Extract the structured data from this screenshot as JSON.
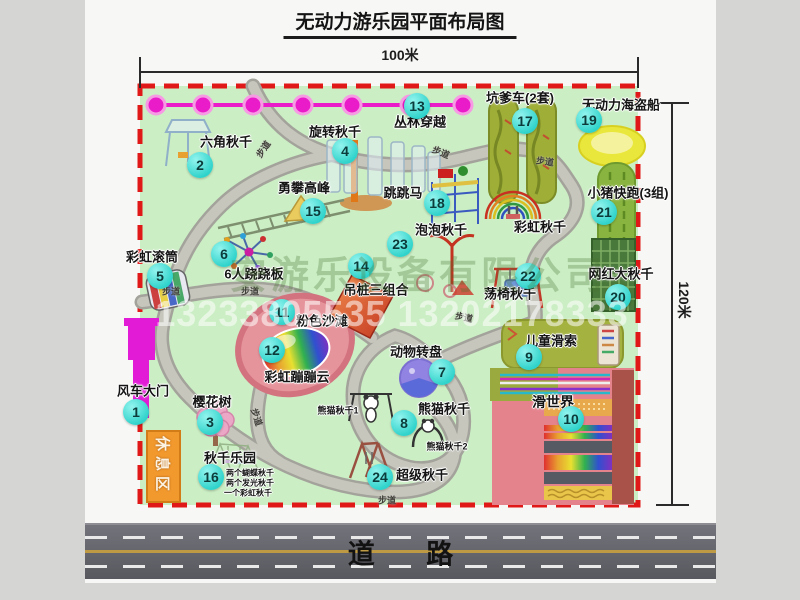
{
  "title": "无动力游乐园平面布局图",
  "dimensions": {
    "width": "100米",
    "height": "120米"
  },
  "road": {
    "label": "道 路"
  },
  "rest_area": {
    "label": "休息区"
  },
  "path_label_text": "步道",
  "path_labels": [
    [
      263,
      149,
      -55
    ],
    [
      441,
      152,
      22
    ],
    [
      545,
      161,
      8
    ],
    [
      171,
      291,
      0
    ],
    [
      250,
      291,
      0
    ],
    [
      257,
      417,
      72
    ],
    [
      464,
      317,
      12
    ],
    [
      387,
      500,
      0
    ]
  ],
  "watermark": {
    "company": "安游乐设备有限公司",
    "phone": "13233805535 13202178333"
  },
  "items": [
    {
      "num": 1,
      "label": "风车大门",
      "badge": [
        136,
        412
      ],
      "text": [
        143,
        390
      ]
    },
    {
      "num": 2,
      "label": "六角秋千",
      "badge": [
        200,
        165
      ],
      "text": [
        226,
        141
      ]
    },
    {
      "num": 3,
      "label": "樱花树",
      "badge": [
        210,
        422
      ],
      "text": [
        212,
        401
      ]
    },
    {
      "num": 4,
      "label": "旋转秋千",
      "badge": [
        345,
        151
      ],
      "text": [
        335,
        131
      ]
    },
    {
      "num": 5,
      "label": "彩虹滚筒",
      "badge": [
        160,
        276
      ],
      "text": [
        152,
        256
      ]
    },
    {
      "num": 6,
      "label": "6人跷跷板",
      "badge": [
        224,
        254
      ],
      "text": [
        254,
        273
      ]
    },
    {
      "num": 7,
      "label": "动物转盘",
      "badge": [
        442,
        372
      ],
      "text": [
        416,
        351
      ]
    },
    {
      "num": 8,
      "label": "熊猫秋千",
      "badge": [
        404,
        423
      ],
      "text": [
        444,
        408
      ]
    },
    {
      "num": 9,
      "label": "儿童滑索",
      "badge": [
        529,
        357
      ],
      "text": [
        551,
        340
      ]
    },
    {
      "num": 10,
      "label": "滑世界",
      "badge": [
        571,
        419
      ],
      "text": [
        553,
        402
      ],
      "size": 14
    },
    {
      "num": 11,
      "label": "粉色沙滩",
      "badge": [
        282,
        312
      ],
      "text": [
        322,
        320
      ]
    },
    {
      "num": 12,
      "label": "彩虹蹦蹦云",
      "badge": [
        272,
        350
      ],
      "text": [
        297,
        376
      ]
    },
    {
      "num": 13,
      "label": "丛林穿越",
      "badge": [
        417,
        106
      ],
      "text": [
        420,
        121
      ]
    },
    {
      "num": 14,
      "label": "吊桩三组合",
      "badge": [
        361,
        266
      ],
      "text": [
        376,
        289
      ]
    },
    {
      "num": 15,
      "label": "勇攀高峰",
      "badge": [
        313,
        211
      ],
      "text": [
        304,
        187
      ]
    },
    {
      "num": 16,
      "label": "秋千乐园",
      "badge": [
        211,
        477
      ],
      "text": [
        230,
        457
      ]
    },
    {
      "num": 17,
      "label": "坑爹车(2套)",
      "badge": [
        525,
        121
      ],
      "text": [
        520,
        97
      ]
    },
    {
      "num": 18,
      "label": "跳跳马",
      "badge": [
        437,
        203
      ],
      "text": [
        403,
        192
      ]
    },
    {
      "num": 19,
      "label": "无动力海盗船",
      "badge": [
        589,
        120
      ],
      "text": [
        621,
        104
      ]
    },
    {
      "num": 20,
      "label": "网红大秋千",
      "badge": [
        618,
        297
      ],
      "text": [
        621,
        273
      ]
    },
    {
      "num": 21,
      "label": "小猪快跑(3组)",
      "badge": [
        604,
        212
      ],
      "text": [
        628,
        192
      ]
    },
    {
      "num": 22,
      "label": "荡椅秋千",
      "badge": [
        528,
        276
      ],
      "text": [
        510,
        293
      ]
    },
    {
      "num": 23,
      "label": "泡泡秋千",
      "badge": [
        400,
        244
      ],
      "text": [
        441,
        229
      ]
    },
    {
      "num": 24,
      "label": "超级秋千",
      "badge": [
        380,
        477
      ],
      "text": [
        422,
        474
      ]
    }
  ],
  "annotations": [
    {
      "text": "彩虹秋千",
      "x": 540,
      "y": 226,
      "size": 13
    },
    {
      "text": "熊猫秋千1",
      "x": 338,
      "y": 410,
      "size": 9
    },
    {
      "text": "熊猫秋千2",
      "x": 447,
      "y": 446,
      "size": 9
    },
    {
      "text": "两个蝴蝶秋千",
      "x": 250,
      "y": 473,
      "size": 8
    },
    {
      "text": "两个发光秋千",
      "x": 250,
      "y": 483,
      "size": 8
    },
    {
      "text": "一个彩虹秋千",
      "x": 248,
      "y": 493,
      "size": 8
    }
  ],
  "colors": {
    "park_green": "#cbeec4",
    "boundary_red": "#e01818",
    "badge_cyan": "#2fd3cb",
    "zipline_magenta": "#ea1cc9",
    "gate_magenta": "#e21bd6",
    "rest_orange": "#f2992e",
    "road_gray": "#5a5a61",
    "path_gray": "#c6c6bd"
  }
}
